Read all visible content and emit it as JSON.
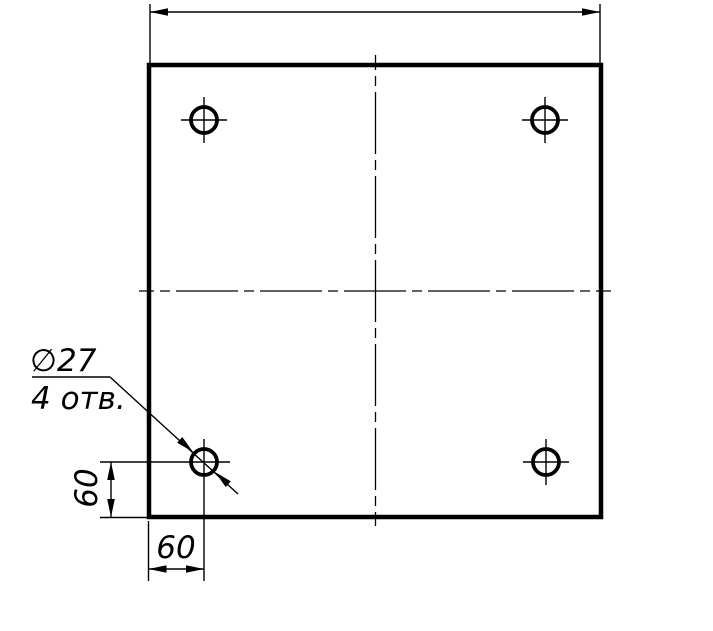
{
  "drawing": {
    "description": "square plate with four drilled holes",
    "colors": {
      "line": "#000000",
      "background": "#ffffff"
    },
    "labels": {
      "hole_diameter": "∅27",
      "hole_count": "4 отв.",
      "left_dim": "60",
      "bottom_dim": "60"
    }
  }
}
